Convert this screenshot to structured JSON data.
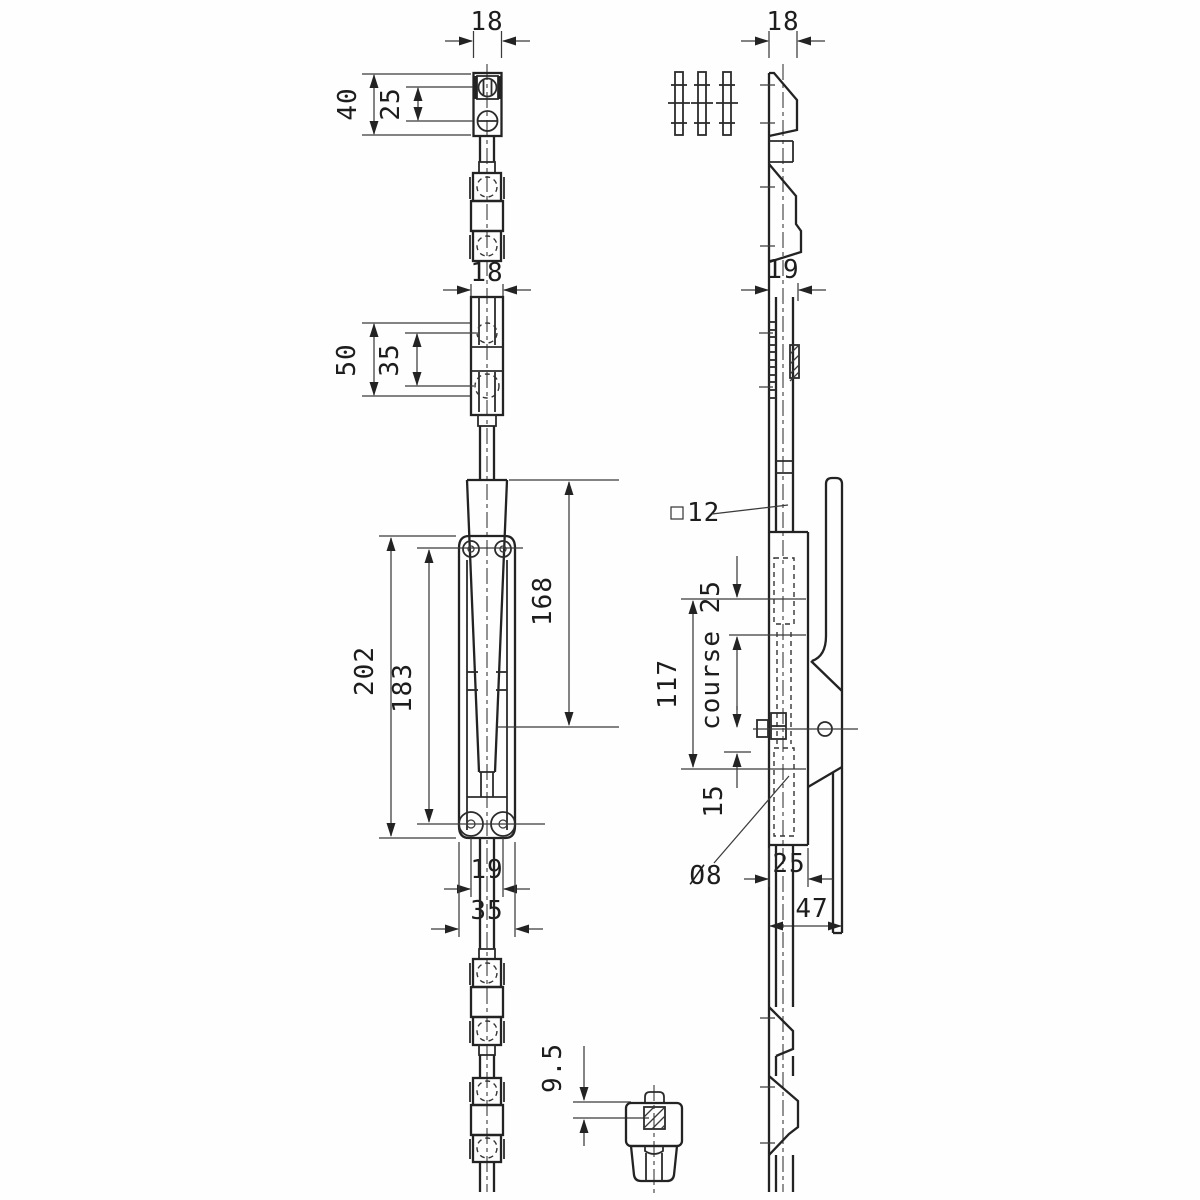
{
  "drawing": {
    "background": "#fefefe",
    "ink": "#232323",
    "type": "espagnolette-bolt-technical-drawing",
    "views": {
      "front": {
        "dims": {
          "width_top": "18",
          "keeper_height": "40",
          "keeper_hole_spacing": "25",
          "width_mid": "18",
          "guide_height": "50",
          "guide_hole_spacing": "35",
          "lever_length": "168",
          "plate_length": "202",
          "hole_span": "183",
          "screw_spacing": "19",
          "plate_width": "35"
        }
      },
      "side": {
        "dims": {
          "depth_top": "18",
          "depth_channel": "19",
          "rod_square": "12",
          "body_span": "117",
          "travel": "course 25",
          "offset_bottom": "15",
          "hole_dia": "Ø8",
          "case_depth": "25",
          "overall_depth": "47"
        }
      },
      "detail": {
        "dims": {
          "rod_thickness": "9.5"
        }
      }
    }
  }
}
